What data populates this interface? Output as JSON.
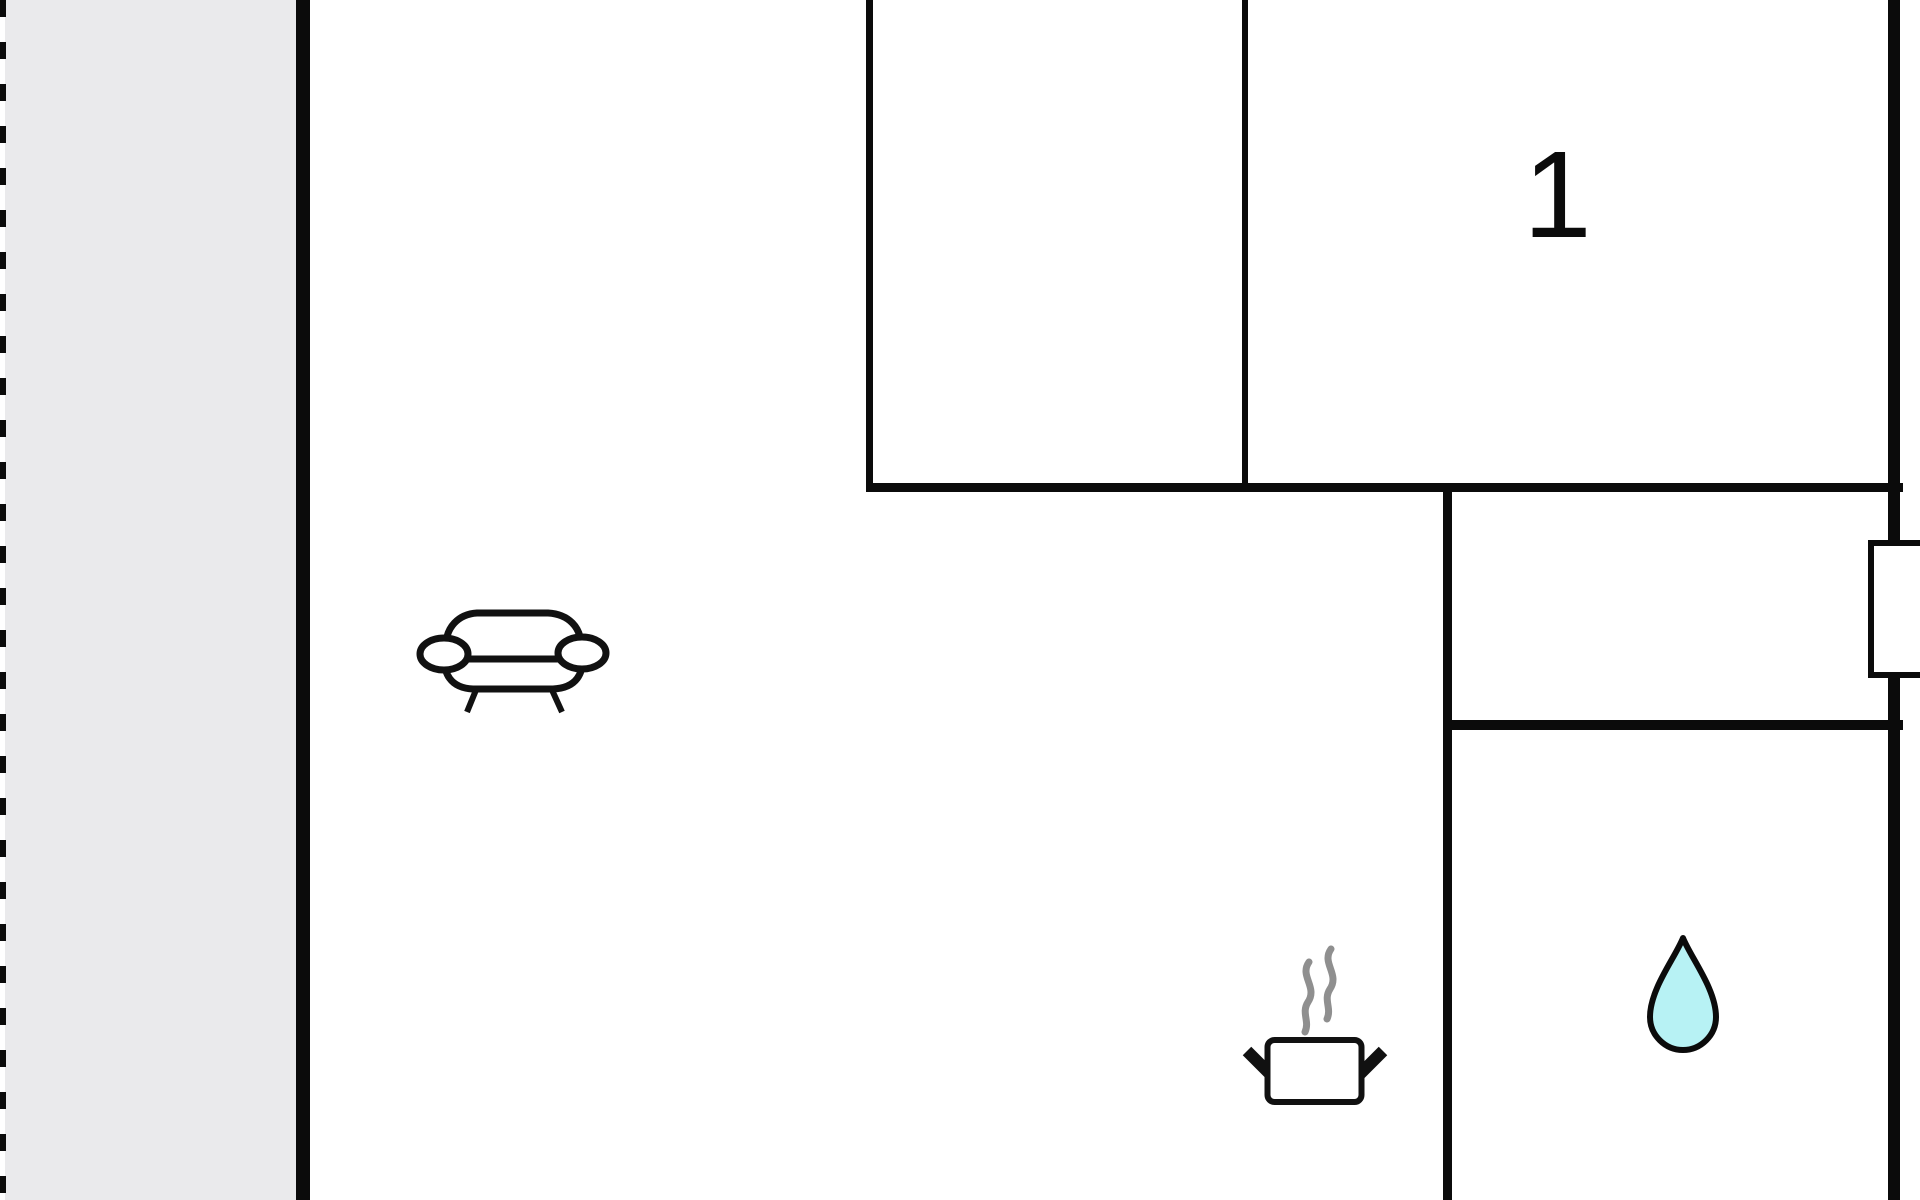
{
  "floorplan": {
    "room_label": "1",
    "colors": {
      "background": "#ffffff",
      "wall": "#0b0b0b",
      "terrace_fill": "#eaeaec",
      "window_fill": "#ffffff",
      "icon_outline": "#111111",
      "steam": "#8f8f8f",
      "water_drop_fill": "#b7f2f4",
      "room_label_color": "#0b0b0b"
    },
    "icons": [
      "sofa-icon",
      "steam-icon",
      "cooking-pot-icon",
      "water-drop-icon"
    ]
  }
}
